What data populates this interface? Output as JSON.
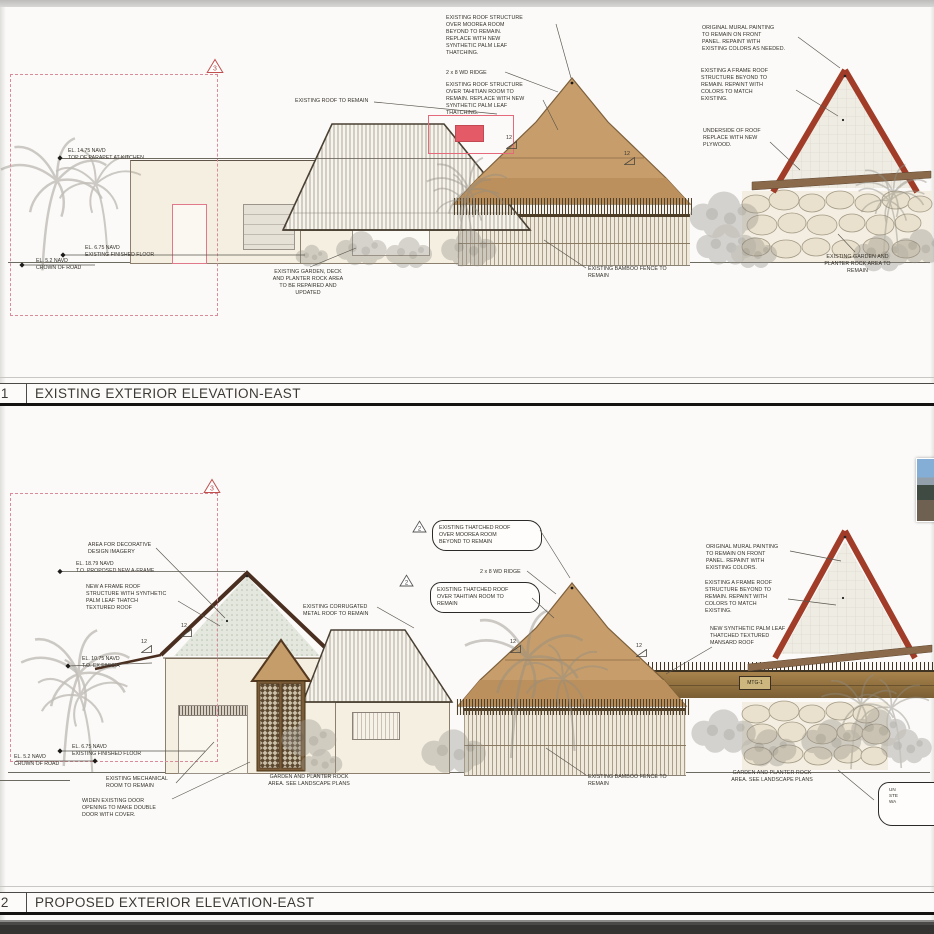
{
  "common": {
    "slope": "12"
  },
  "existing": {
    "number": "01",
    "title": "EXISTING EXTERIOR ELEVATION-EAST",
    "rev": "3",
    "notes": {
      "moorea": "EXISTING ROOF STRUCTURE\nOVER MOOREA ROOM\nBEYOND TO REMAIN.\nREPLACE WITH NEW\nSYNTHETIC PALM LEAF\nTHATCHING.",
      "ridge": "2 x 8 WD RIDGE",
      "tahitian": "EXISTING ROOF STRUCTURE\nOVER TAHITIAN ROOM TO\nREMAIN. REPLACE WITH NEW\nSYNTHETIC PALM LEAF\nTHATCHING.",
      "roof_remain": "EXISTING ROOF TO REMAIN",
      "mural": "ORIGINAL MURAL PAINTING\nTO REMAIN ON FRONT\nPANEL. REPAINT WITH\nEXISTING COLORS AS NEEDED.",
      "aframe_beyond": "EXISTING A FRAME ROOF\nSTRUCTURE BEYOND TO\nREMAIN. REPAINT WITH\nCOLORS TO MATCH\nEXISTING.",
      "underside": "UNDERSIDE OF ROOF\nREPLACE WITH NEW\nPLYWOOD.",
      "garden_deck": "EXISTING GARDEN, DECK\nAND PLANTER ROCK AREA\nTO BE REPAIRED AND\nUPDATED",
      "bamboo": "EXISTING BAMBOO FENCE TO\nREMAIN",
      "garden_rock": "EXISTING GARDEN AND\nPLANTER ROCK AREA TO\nREMAIN"
    },
    "elev": {
      "parapet": {
        "el": "EL. 14.75 NAVD",
        "label": "TOP OF PARAPET AT KITCHEN"
      },
      "ff": {
        "el": "EL. 6.75 NAVD",
        "label": "EXISTING FINISHED FLOOR"
      },
      "road": {
        "el": "EL. 5.2 NAVD",
        "label": "CROWN OF ROAD"
      }
    }
  },
  "proposed": {
    "number": "02",
    "title": "PROPOSED EXTERIOR ELEVATION-EAST",
    "rev_cloud": "3",
    "rev_note": "2",
    "mtg_tag": "MTG-1",
    "notes": {
      "decorative": "AREA FOR DECORATIVE\nDESIGN IMAGERY",
      "new_aframe": "NEW A FRAME ROOF\nSTRUCTURE WITH SYNTHETIC\nPALM LEAF THATCH\nTEXTURED ROOF",
      "corrugated": "EXISTING CORRUGATED\nMETAL ROOF TO REMAIN",
      "cloud_moorea": "EXISTING THATCHED ROOF\nOVER MOOREA ROOM\nBEYOND TO REMAIN",
      "ridge": "2 x 8 WD RIDGE",
      "cloud_tahitian": "EXISTING THATCHED ROOF\nOVER TAHITIAN ROOM TO\nREMAIN",
      "mural": "ORIGINAL MURAL PAINTING\nTO REMAIN ON FRONT\nPANEL. REPAINT WITH\nEXISTING COLORS.",
      "aframe_beyond": "EXISTING A FRAME ROOF\nSTRUCTURE BEYOND TO\nREMAIN. REPAINT WITH\nCOLORS TO MATCH\nEXISTING.",
      "mansard": "NEW SYNTHETIC PALM LEAF\nTHATCHED TEXTURED\nMANSARD ROOF",
      "mech": "EXISTING MECHANICAL\nROOM TO REMAIN",
      "widen": "WIDEN EXISTING DOOR\nOPENING TO MAKE DOUBLE\nDOOR WITH COVER.",
      "garden_left": "GARDEN AND PLANTER ROCK\nAREA. SEE LANDSCAPE PLANS",
      "bamboo": "EXISTING BAMBOO FENCE TO\nREMAIN",
      "garden_right": "GARDEN AND PLANTER ROCK\nAREA. SEE LANDSCAPE PLANS",
      "corner_fragment": "UN\nSTE\nWA"
    },
    "elev": {
      "aframe_top": {
        "el": "EL. 18.79 NAVD",
        "label": "T.O. PROPOSED NEW A-FRAME"
      },
      "fascia": {
        "el": "EL. 10.75 NAVD",
        "label": "T.O. EX FASCIA"
      },
      "ff": {
        "el": "EL. 6.75 NAVD",
        "label": "EXISTING FINISHED FLOOR"
      },
      "road": {
        "el": "EL. 5.2 NAVD",
        "label": "CROWN OF ROAD"
      }
    }
  }
}
